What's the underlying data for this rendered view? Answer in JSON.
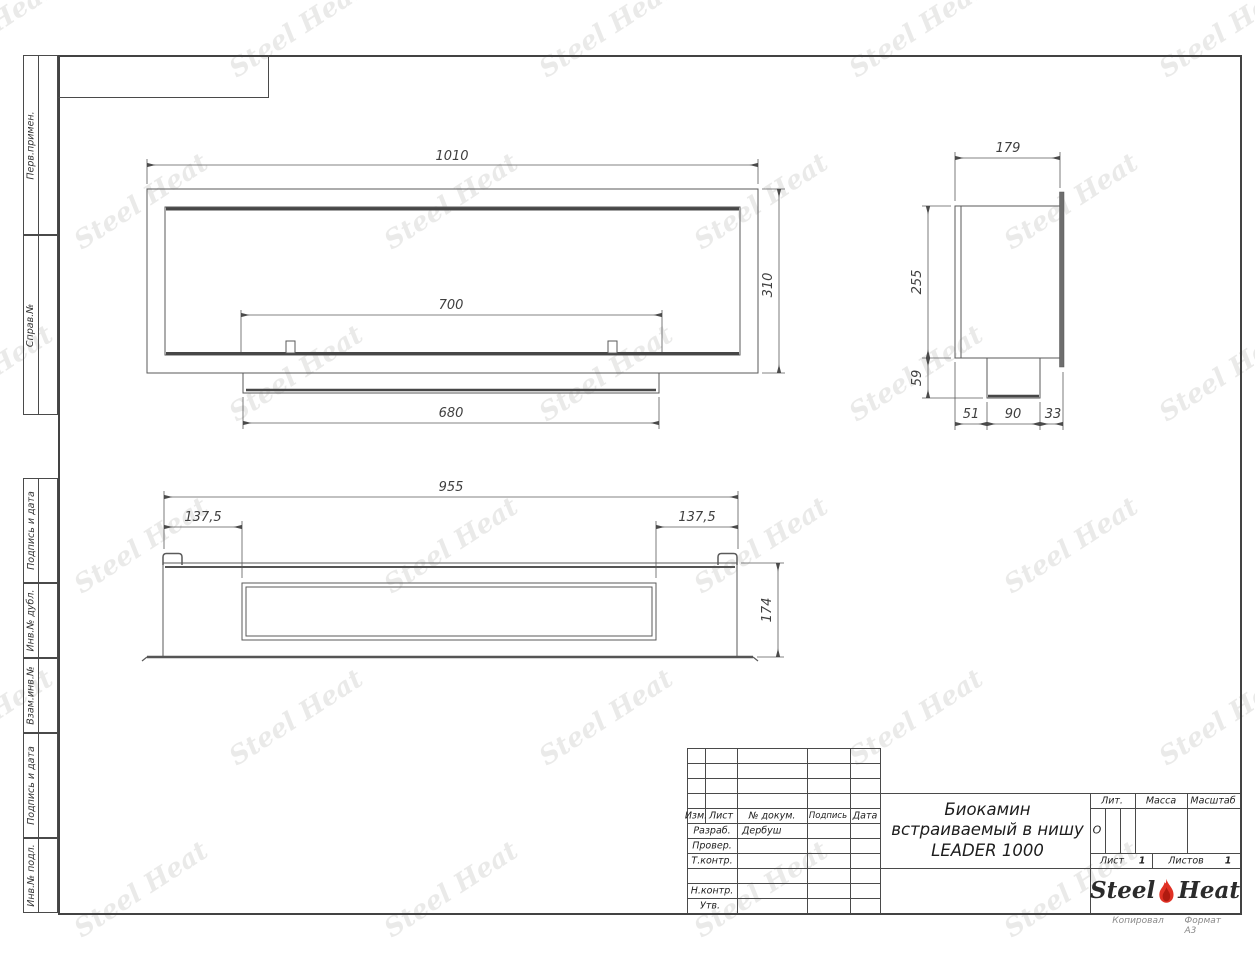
{
  "watermark": {
    "text": "Steel Heat"
  },
  "side_labels": [
    "Перв.примен.",
    "Справ.№",
    "Подпись и дата",
    "Инв.№ дубл.",
    "Взам.инв.№",
    "Подпись и дата",
    "Инв.№ подл."
  ],
  "dims": {
    "front": {
      "width": "1010",
      "height": "310",
      "opening": "700",
      "insert": "680"
    },
    "side": {
      "depth": "179",
      "height": "255",
      "foot": "59",
      "d1": "51",
      "d2": "90",
      "d3": "33"
    },
    "top": {
      "width": "955",
      "left_offset": "137,5",
      "right_offset": "137,5",
      "height": "174"
    }
  },
  "title_block": {
    "header": {
      "izm": "Изм.",
      "list": "Лист",
      "doc": "№ докум.",
      "sign": "Подпись",
      "date": "Дата"
    },
    "roles": [
      {
        "label": "Разраб.",
        "value": "Дербуш"
      },
      {
        "label": "Провер.",
        "value": ""
      },
      {
        "label": "Т.контр.",
        "value": ""
      },
      {
        "label": "Н.контр.",
        "value": ""
      },
      {
        "label": "Утв.",
        "value": ""
      }
    ],
    "title_line1": "Биокамин",
    "title_line2": "встраиваемый в нишу",
    "title_line3": "LEADER 1000",
    "lit_label": "Лит.",
    "lit_value": "О",
    "mass_label": "Масса",
    "scale_label": "Масштаб",
    "sheet_label": "Лист",
    "sheet_value": "1",
    "sheets_label": "Листов",
    "sheets_value": "1",
    "logo": {
      "steel": "Steel",
      "heat": "Heat"
    }
  },
  "footer": {
    "copied": "Копировал",
    "format": "Формат A3"
  }
}
